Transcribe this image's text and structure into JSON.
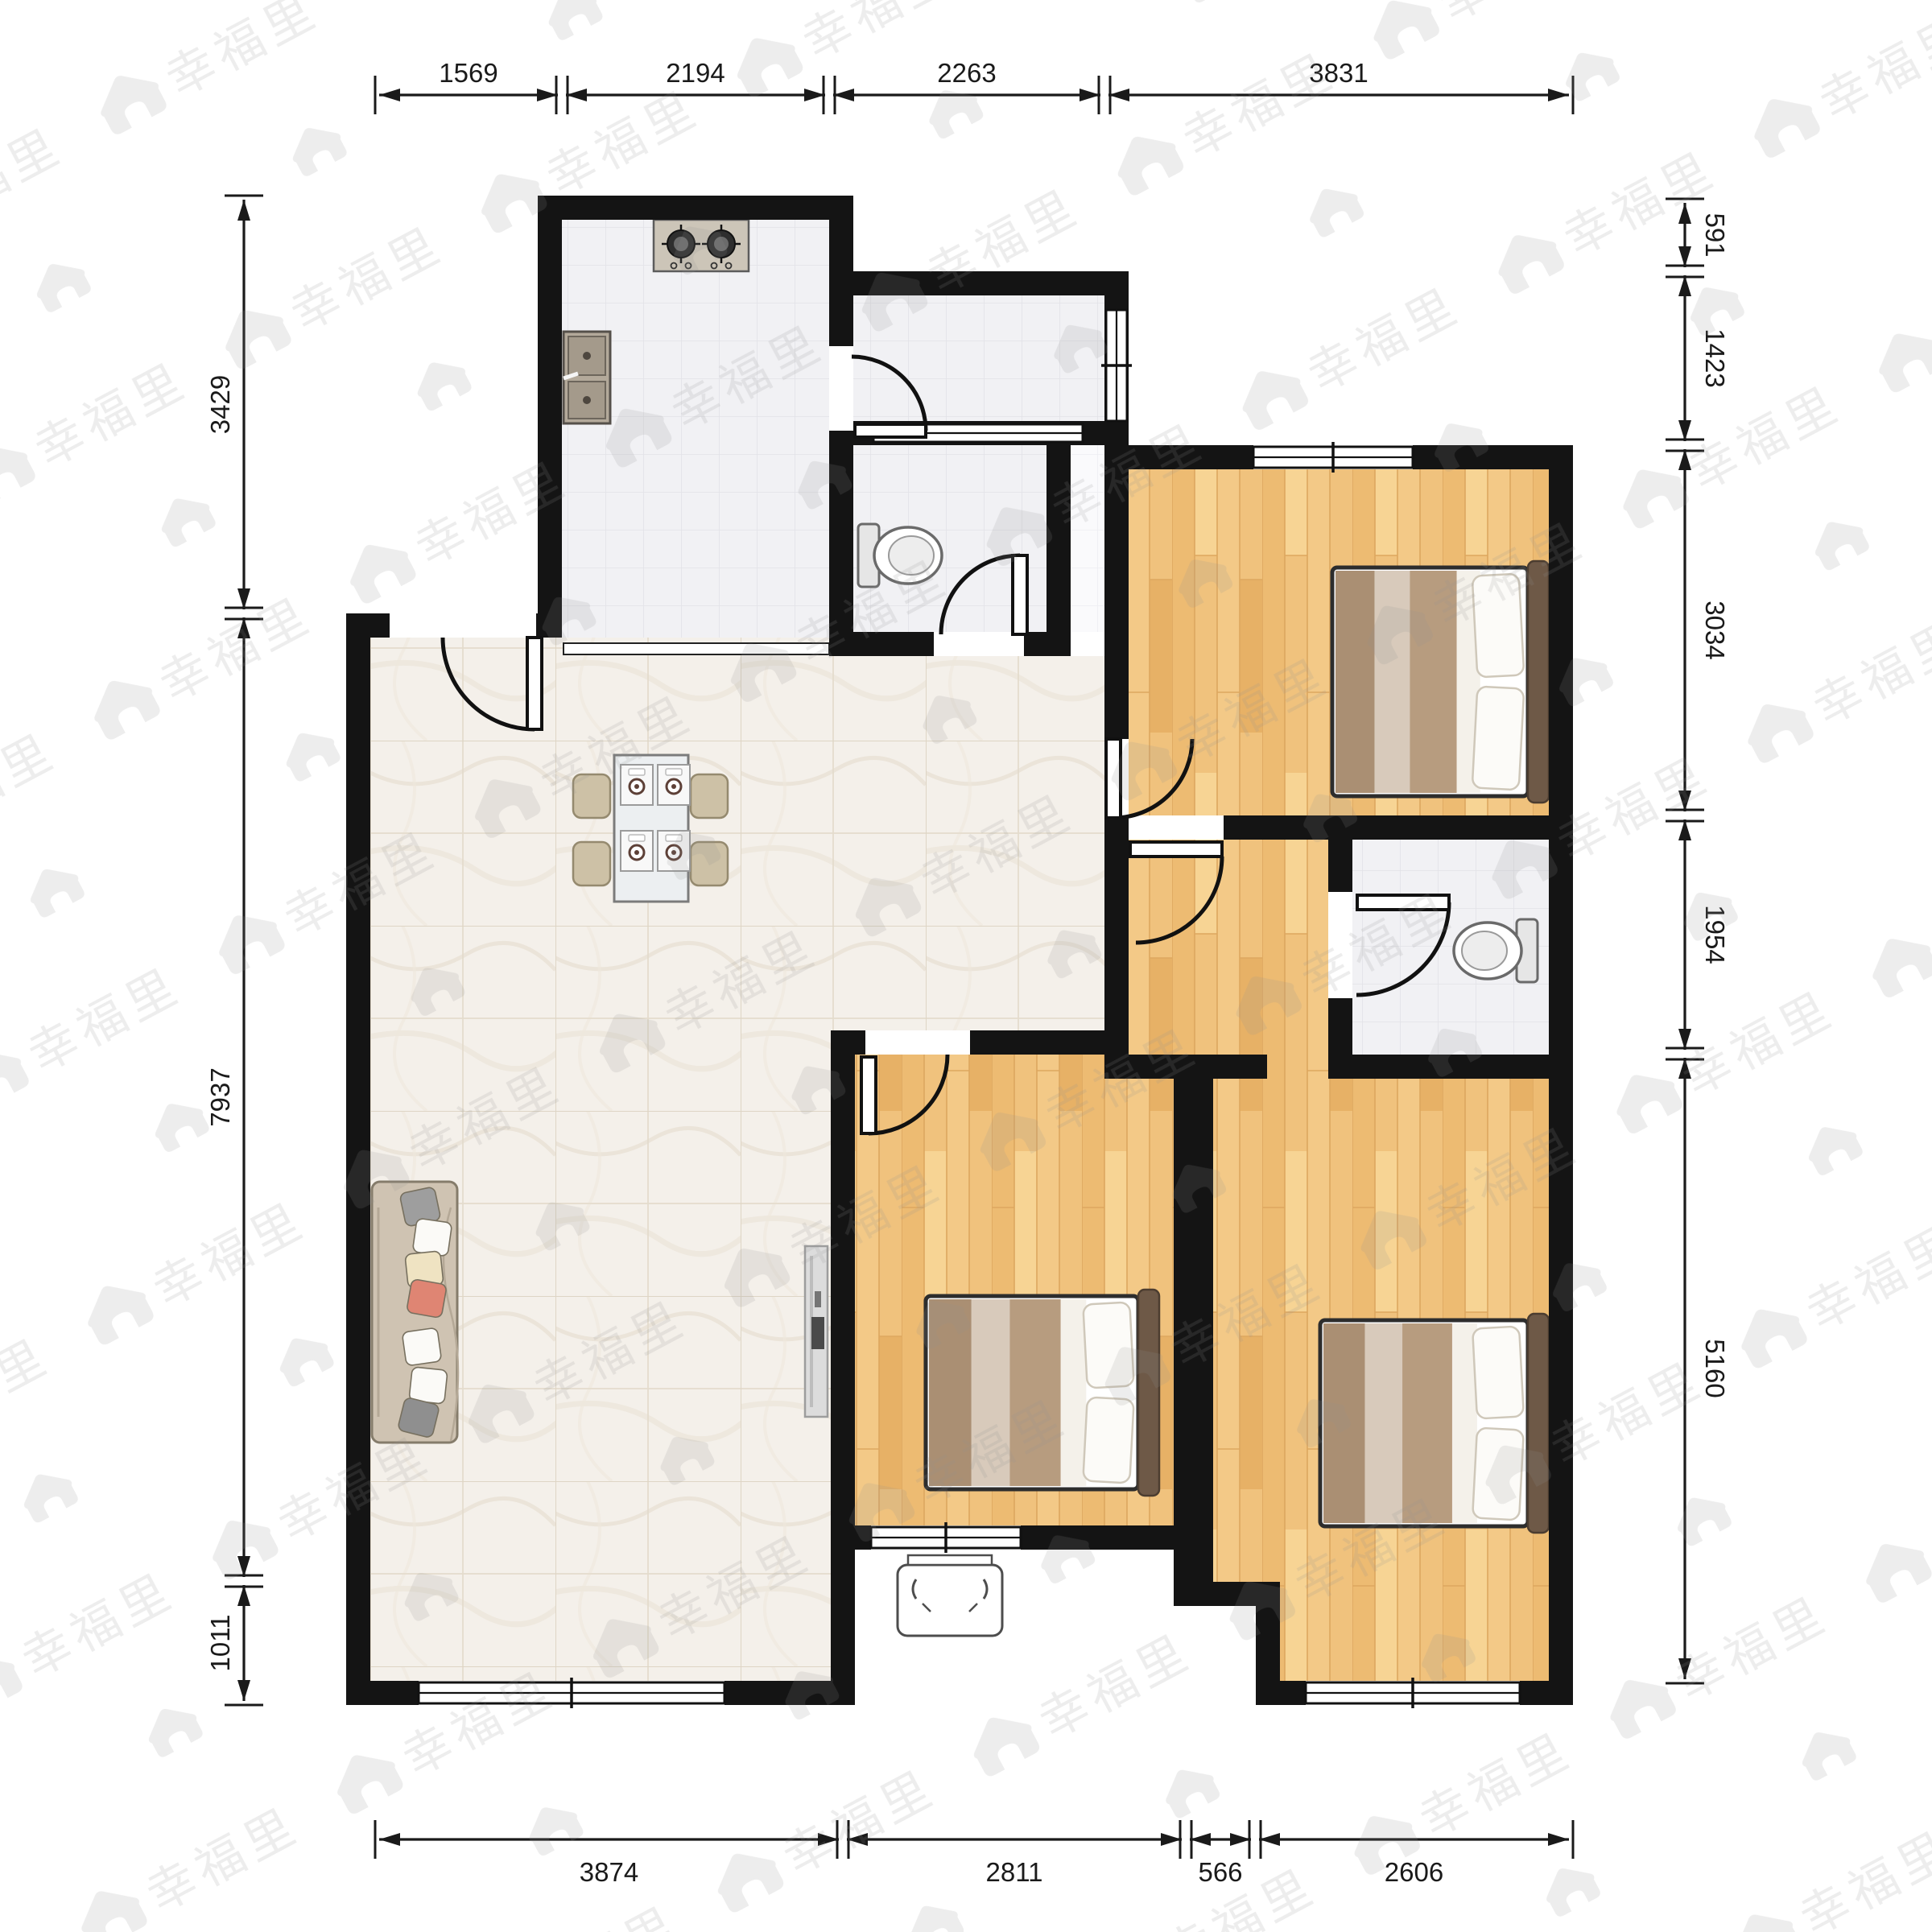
{
  "watermark": {
    "text": "幸福里",
    "icon": "house-icon"
  },
  "dimensions": {
    "top": [
      "1569",
      "2194",
      "2263",
      "3831"
    ],
    "bottom": [
      "3874",
      "2811",
      "566",
      "2606"
    ],
    "left": [
      "3429",
      "7937",
      "1011"
    ],
    "right": [
      "591",
      "1423",
      "3034",
      "1954",
      "5160"
    ]
  },
  "colors": {
    "wall": "#141414",
    "wood_floor": "#f0c27d",
    "marble_floor": "#f4f0ea",
    "tile_floor": "#f1f1f4",
    "sofa": "#cfc3b2",
    "headboard": "#6e5947",
    "blanket": "#b79c7f",
    "dimension_text": "#1a1a1a",
    "accent_pillow": "#df8573"
  }
}
